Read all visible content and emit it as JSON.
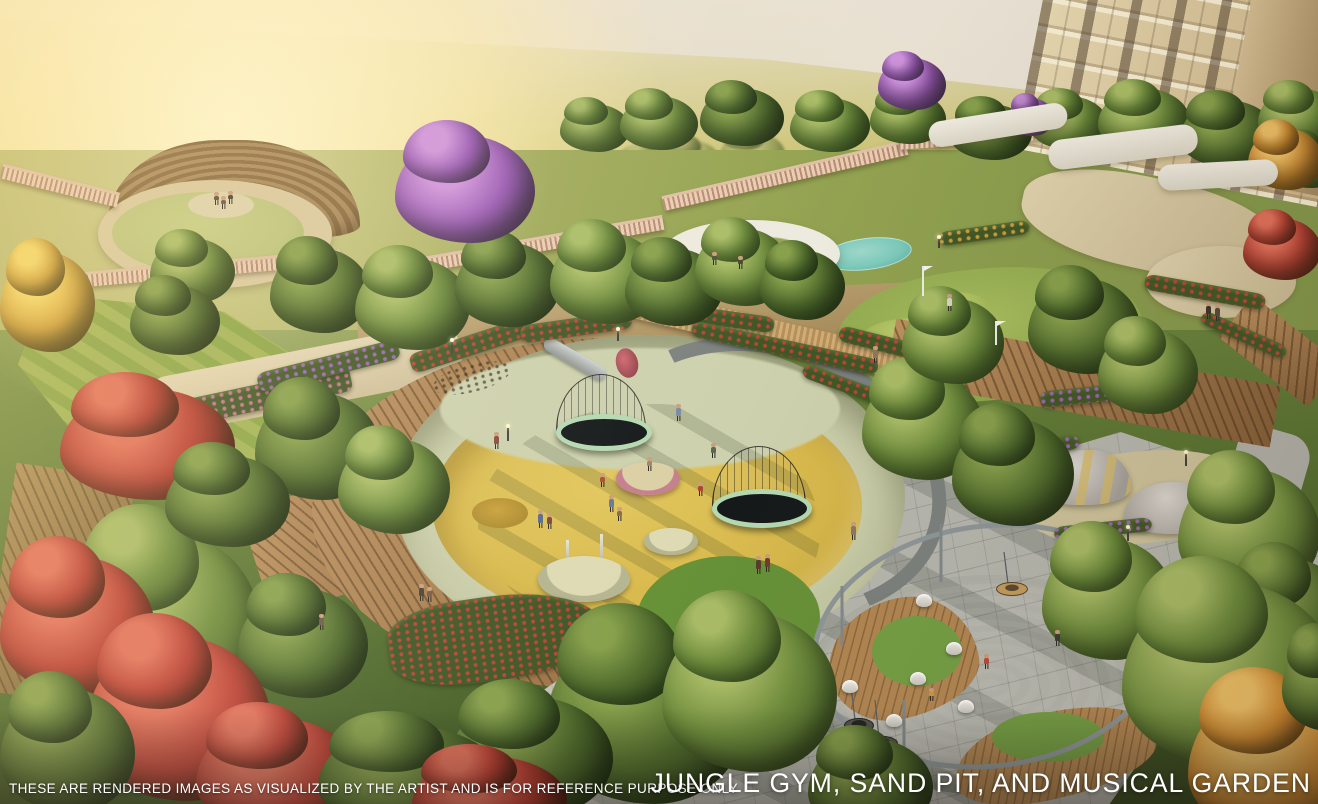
{
  "captions": {
    "disclaimer": "THESE ARE RENDERED IMAGES AS VISUALIZED BY THE ARTIST AND IS FOR REFERENCE PURPOSE ONLY",
    "title": "JUNGLE GYM, SAND PIT, AND MUSICAL GARDEN"
  },
  "colors": {
    "sky-gold": "#f3e3a8",
    "sky-haze": "#e7dfd2",
    "hill": "#d5ca78",
    "amph-lawn": "#bdc47e",
    "amph-steps": "#8a6b42",
    "sand": "#d7b84b",
    "pit-rim": "#cbcfab",
    "pit-grass": "#6f9a40",
    "plaza": "#b7b8b0",
    "wood": "#a97c4c",
    "water": "#7ccabb",
    "canopy": "#edeadf",
    "balustrade": "#e8cdb2",
    "hedge": "#415626",
    "flower-red": "#cc4438",
    "flower-pink": "#d878a0",
    "flower-purple": "#a868c8",
    "flower-gold": "#e0a93e",
    "foliage-purple": "#9b59b8",
    "foliage-orange": "#d8892f",
    "building": "#ddcda6",
    "pipe": "#8f979a",
    "trampoline-rim": "#b5d9b2",
    "platform-pink": "#c57f8e",
    "caption-text": "#ffffff"
  }
}
